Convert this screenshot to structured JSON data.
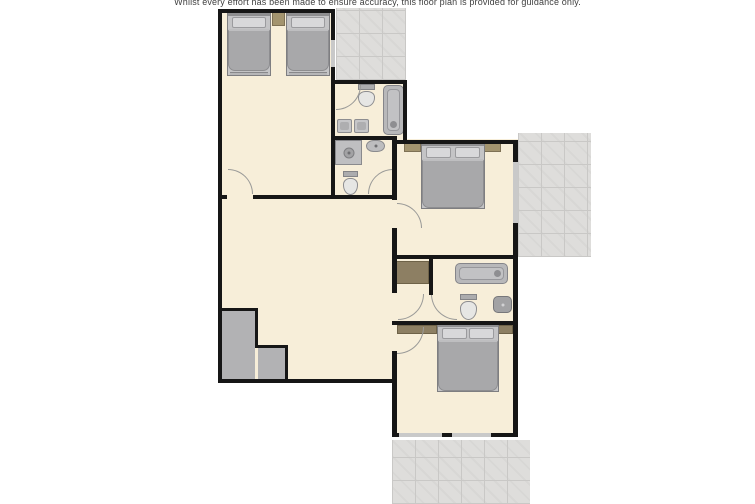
{
  "disclaimer": "Whilst every effort has been made to ensure accuracy, this floor plan is provided for guidance only.",
  "colors": {
    "floor": "#f7eed9",
    "wall": "#161616",
    "terrace": "#dedddb",
    "tline": "#c9c8c6",
    "stairs": "#b2b2b4",
    "window": "#c9c9c9",
    "pillow": "#d8d8da",
    "bed": "#a8a8aa",
    "wood": "#a3946f",
    "woodline": "#7e7155"
  },
  "plan": {
    "rooms": [
      {
        "name": "twin-bedroom",
        "rect": [
          218,
          9,
          117,
          190
        ]
      },
      {
        "name": "bathroom-1",
        "rect": [
          331,
          80,
          76,
          60
        ]
      },
      {
        "name": "shower-room",
        "rect": [
          331,
          136,
          66,
          63
        ]
      },
      {
        "name": "double-bedroom-1",
        "rect": [
          392,
          139,
          126,
          120
        ]
      },
      {
        "name": "living-room",
        "rect": [
          218,
          195,
          179,
          188
        ]
      },
      {
        "name": "hallway",
        "rect": [
          392,
          255,
          41,
          70
        ]
      },
      {
        "name": "bathroom-2",
        "rect": [
          429,
          255,
          89,
          70
        ]
      },
      {
        "name": "double-bedroom-2",
        "rect": [
          392,
          321,
          126,
          116
        ]
      }
    ],
    "terraces": [
      {
        "name": "terrace-top",
        "rect": [
          336,
          8,
          70,
          72
        ]
      },
      {
        "name": "terrace-right",
        "rect": [
          518,
          133,
          73,
          124
        ]
      },
      {
        "name": "patio-bottom",
        "rect": [
          392,
          440,
          138,
          64
        ]
      }
    ],
    "walls": [
      [
        218,
        9,
        4,
        374
      ],
      [
        218,
        9,
        117,
        4
      ],
      [
        331,
        9,
        4,
        190
      ],
      [
        218,
        195,
        9,
        4
      ],
      [
        253,
        195,
        143,
        4
      ],
      [
        331,
        80,
        76,
        4
      ],
      [
        403,
        80,
        4,
        60
      ],
      [
        331,
        136,
        66,
        4
      ],
      [
        392,
        136,
        5,
        64
      ],
      [
        392,
        228,
        5,
        65
      ],
      [
        392,
        321,
        5,
        4
      ],
      [
        392,
        351,
        5,
        86
      ],
      [
        392,
        140,
        126,
        4
      ],
      [
        513,
        140,
        5,
        119
      ],
      [
        392,
        255,
        126,
        4
      ],
      [
        218,
        379,
        179,
        4
      ],
      [
        429,
        259,
        4,
        36
      ],
      [
        513,
        255,
        5,
        182
      ],
      [
        392,
        321,
        126,
        4
      ],
      [
        392,
        433,
        126,
        4
      ]
    ],
    "windows": [
      [
        331,
        40,
        4,
        27
      ],
      [
        513,
        162,
        5,
        61
      ],
      [
        399,
        433,
        43,
        4
      ],
      [
        452,
        433,
        39,
        4
      ]
    ],
    "stairs": {
      "fills": [
        [
          222,
          311,
          33,
          68
        ],
        [
          258,
          348,
          27,
          31
        ]
      ],
      "borders": [
        [
          222,
          308,
          36,
          3
        ],
        [
          255,
          308,
          3,
          40
        ],
        [
          255,
          345,
          33,
          3
        ],
        [
          285,
          345,
          3,
          34
        ]
      ]
    },
    "furniture": [
      {
        "type": "bed-single",
        "name": "single-bed-1",
        "rect": [
          227,
          11,
          44,
          65
        ]
      },
      {
        "type": "bed-single",
        "name": "single-bed-2",
        "rect": [
          286,
          11,
          44,
          65
        ]
      },
      {
        "type": "nightstand",
        "name": "bedside-table-1",
        "rect": [
          272,
          11,
          13,
          15
        ]
      },
      {
        "type": "toilet",
        "name": "toilet-1",
        "rect": [
          357,
          84,
          19,
          23
        ]
      },
      {
        "type": "bathtub-v",
        "name": "bathtub-1",
        "rect": [
          383,
          85,
          21,
          50
        ]
      },
      {
        "type": "sink-sq",
        "name": "basin-1",
        "rect": [
          337,
          119,
          15,
          14
        ]
      },
      {
        "type": "sink-sq",
        "name": "basin-2",
        "rect": [
          354,
          119,
          15,
          14
        ]
      },
      {
        "type": "shower",
        "name": "shower-cubicle",
        "rect": [
          335,
          140,
          27,
          25
        ]
      },
      {
        "type": "sink",
        "name": "basin-3",
        "rect": [
          366,
          140,
          19,
          12
        ]
      },
      {
        "type": "toilet",
        "name": "toilet-2",
        "rect": [
          342,
          171,
          17,
          24
        ]
      },
      {
        "type": "nightstand",
        "name": "bedside-table-2",
        "rect": [
          404,
          141,
          17,
          11
        ]
      },
      {
        "type": "nightstand",
        "name": "bedside-table-3",
        "rect": [
          484,
          141,
          17,
          11
        ]
      },
      {
        "type": "bed-double",
        "name": "double-bed-1",
        "rect": [
          421,
          141,
          64,
          68
        ]
      },
      {
        "type": "closet",
        "name": "cupboard",
        "rect": [
          395,
          261,
          34,
          23
        ]
      },
      {
        "type": "bathtub-h",
        "name": "bathtub-2",
        "rect": [
          455,
          263,
          53,
          21
        ]
      },
      {
        "type": "toilet",
        "name": "toilet-3",
        "rect": [
          459,
          294,
          19,
          26
        ]
      },
      {
        "type": "sink-dark",
        "name": "basin-4",
        "rect": [
          493,
          296,
          19,
          17
        ]
      },
      {
        "type": "closet",
        "name": "wardrobe-1",
        "rect": [
          397,
          325,
          40,
          9
        ]
      },
      {
        "type": "closet",
        "name": "wardrobe-2",
        "rect": [
          489,
          325,
          24,
          9
        ]
      },
      {
        "type": "bed-double",
        "name": "double-bed-2",
        "rect": [
          437,
          322,
          62,
          70
        ]
      }
    ],
    "doors": [
      {
        "name": "door-twin-bedroom",
        "rect": [
          228,
          169,
          25,
          25
        ],
        "corner": "tr"
      },
      {
        "name": "door-bathroom-1",
        "rect": [
          336,
          85,
          25,
          25
        ],
        "corner": "br"
      },
      {
        "name": "door-shower-room",
        "rect": [
          368,
          169,
          25,
          25
        ],
        "corner": "tl"
      },
      {
        "name": "door-bedroom-1",
        "rect": [
          397,
          203,
          25,
          25
        ],
        "corner": "tr"
      },
      {
        "name": "door-hallway",
        "rect": [
          398,
          294,
          26,
          26
        ],
        "corner": "br"
      },
      {
        "name": "door-bathroom-2",
        "rect": [
          431,
          294,
          26,
          26
        ],
        "corner": "bl"
      },
      {
        "name": "door-bedroom-2",
        "rect": [
          397,
          327,
          27,
          27
        ],
        "corner": "br"
      }
    ]
  }
}
